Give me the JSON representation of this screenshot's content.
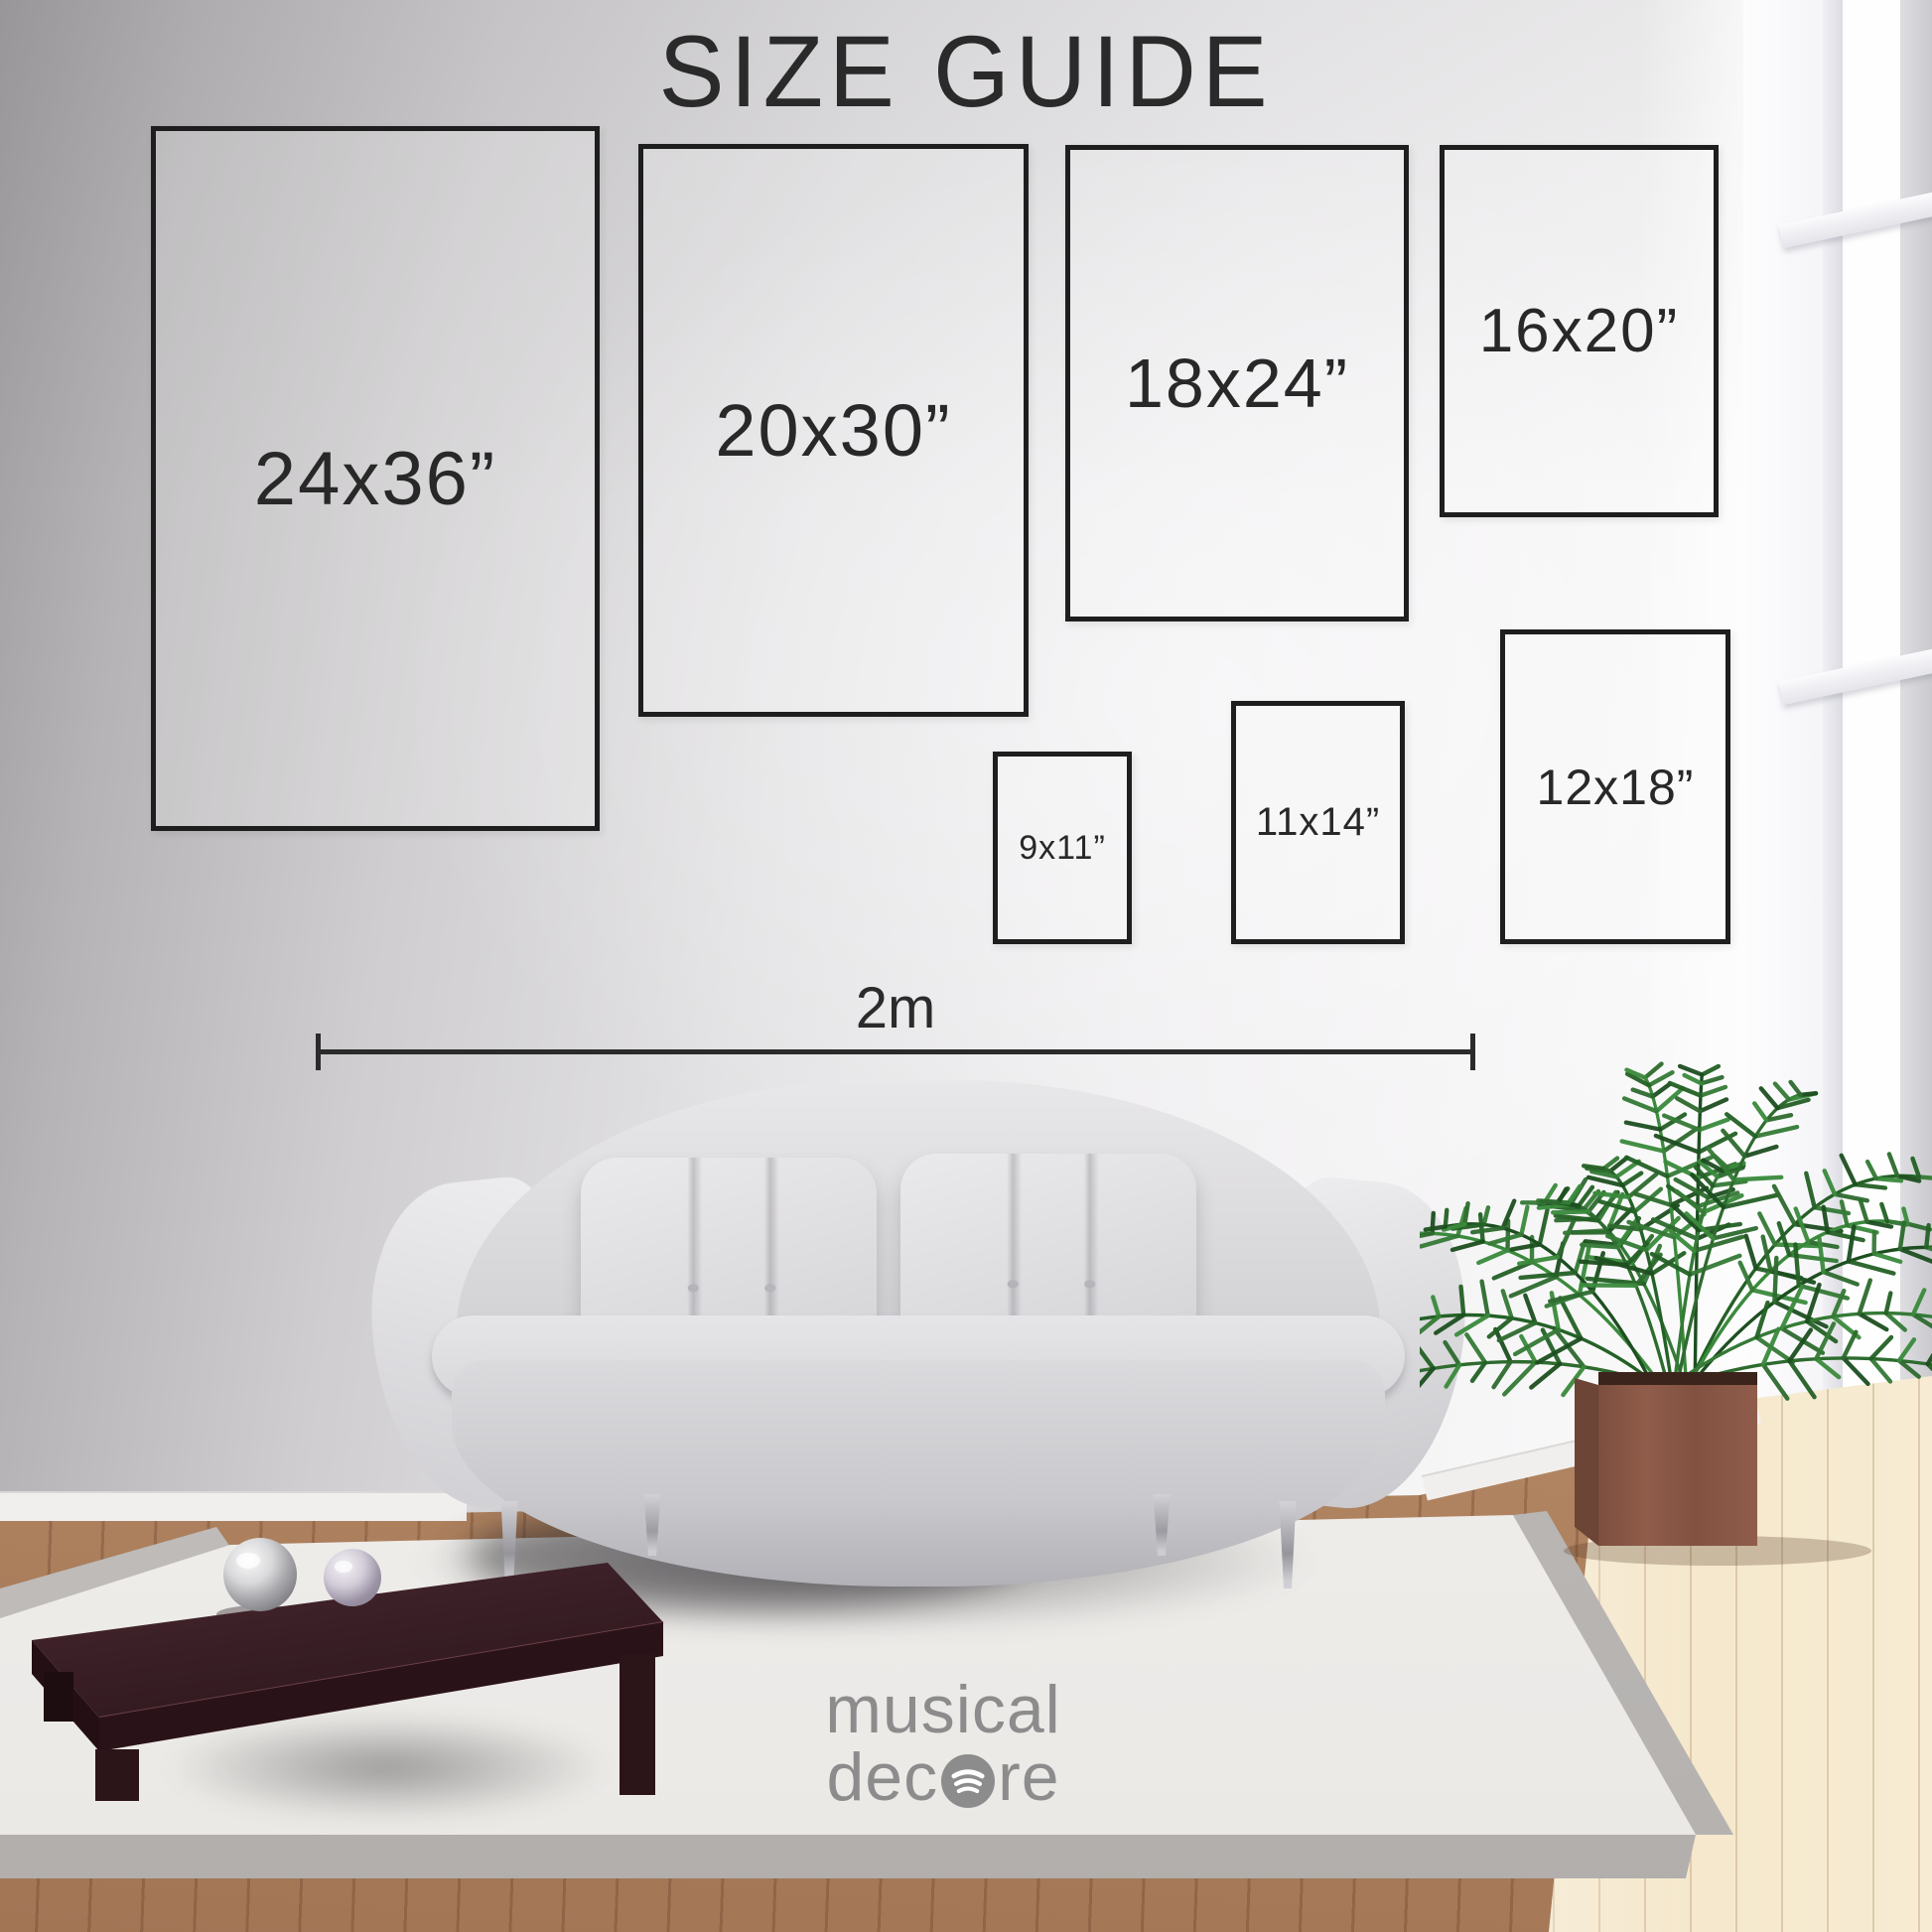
{
  "title": "SIZE GUIDE",
  "size_boxes": [
    {
      "label": "24x36”"
    },
    {
      "label": "20x30”"
    },
    {
      "label": "18x24”"
    },
    {
      "label": "16x20”"
    },
    {
      "label": "9x11”"
    },
    {
      "label": "11x14”"
    },
    {
      "label": "12x18”"
    }
  ],
  "scale_bar": {
    "label": "2m"
  },
  "watermark": {
    "line1": "musical",
    "line2_prefix": "dec",
    "line2_suffix": "re",
    "icon": "spotify-arcs-icon"
  },
  "colors": {
    "outline": "#1e1e1e",
    "size_text": "#282828",
    "title_text": "#2a2a2a",
    "watermark": "#8d8c8d"
  }
}
